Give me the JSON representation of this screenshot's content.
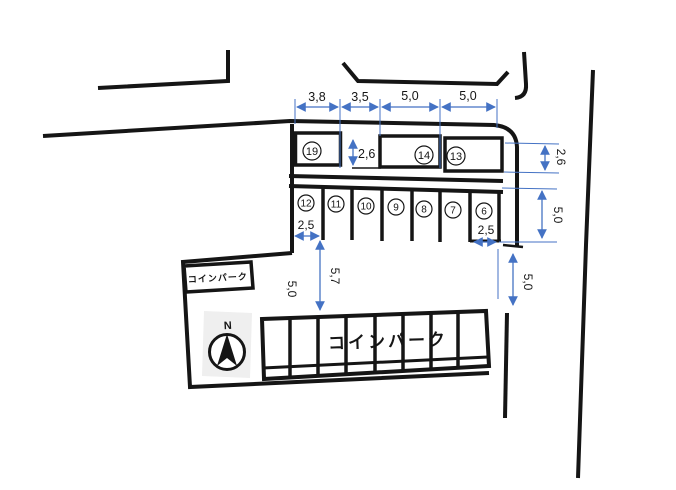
{
  "diagram": {
    "compass": "N",
    "sign_box_label": "コインパーク",
    "lot_label": "コインパーク",
    "upper_stalls": [
      "19",
      "14",
      "13"
    ],
    "lower_stalls": [
      "12",
      "11",
      "10",
      "9",
      "8",
      "7",
      "6"
    ],
    "dims": {
      "top": [
        "3,8",
        "3,5",
        "5,0",
        "5,0"
      ],
      "upper_row_height": "2,6",
      "right_upper_height": "2,6",
      "right_stall_depth": "5,0",
      "right_aisle": "5,0",
      "left_stall_width": "2,5",
      "right_stall_width": "2,5",
      "aisle_depth": "5,7",
      "left_aisle": "5,0"
    },
    "colors": {
      "line": "#151515",
      "dimension": "#4472C4"
    }
  }
}
